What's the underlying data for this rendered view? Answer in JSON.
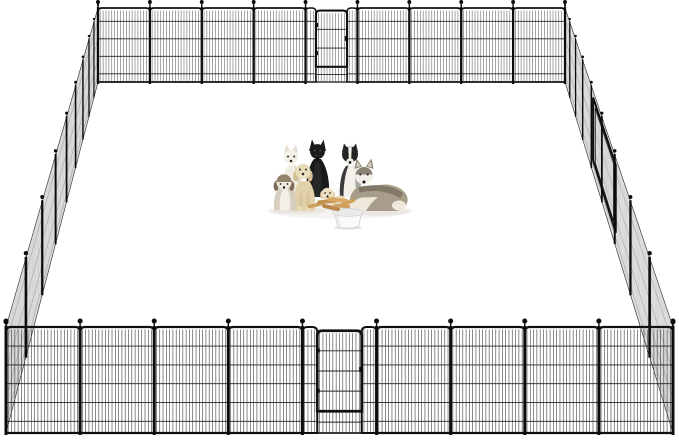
{
  "image": {
    "width": 679,
    "height": 440,
    "background": "#ffffff",
    "scene_description": "Black metal dog playpen fence enclosure, square layout with front and back gate doors, group of dogs with a white food bowl of treat sticks inside"
  },
  "fence": {
    "frame_color": "#101010",
    "wire_color": "#3a3a3a",
    "post_color": "#0c0c0c",
    "side_fill": "#ececec",
    "side_hatch": "#c9c9c9",
    "side_rail": "#9a9a9a",
    "side_outline": "#3c3c3c",
    "back_row": {
      "x1": 98,
      "x2": 565,
      "y_top": 8,
      "y_bottom": 82,
      "panel_count": 9,
      "gate_index": 4,
      "frame_width": 1.7,
      "wire_step": 2.9,
      "h_wires": 4,
      "corner_radius": 4
    },
    "front_row": {
      "x1": 6,
      "x2": 673,
      "y_top": 327,
      "y_bottom": 433,
      "panel_count": 9,
      "gate_index": 4,
      "frame_width": 2.2,
      "wire_step": 3.3,
      "h_wires": 5,
      "corner_radius": 5
    },
    "left_side": {
      "back_top": [
        98,
        8
      ],
      "back_bottom": [
        98,
        82
      ],
      "front_top": [
        6,
        327
      ],
      "front_bottom": [
        6,
        433
      ],
      "panel_count": 9,
      "ratio": 1.22,
      "has_door": false
    },
    "right_side": {
      "back_top": [
        565,
        8
      ],
      "back_bottom": [
        565,
        82
      ],
      "front_top": [
        673,
        327
      ],
      "front_bottom": [
        673,
        433
      ],
      "panel_count": 9,
      "ratio": 1.22,
      "has_door": true,
      "door_t1": 0.26,
      "door_t2": 0.47,
      "door_f1": 0.08,
      "door_f2": 0.84
    }
  },
  "dogs": [
    {
      "id": "black-german-shepherd",
      "pose": "sitting",
      "colors": {
        "body": "#191919",
        "head": "#1b1b1b",
        "chest": "#2e2e2e",
        "muzzle": "#242424",
        "eyes": "#6b5335",
        "nose": "#000000"
      }
    },
    {
      "id": "white-spitz",
      "pose": "sitting",
      "colors": {
        "body": "#f1ede2",
        "shade": "#ddd5c4",
        "head": "#f4f1e9",
        "ears": "#e6dfcf",
        "eyes": "#222222",
        "nose": "#1a1a1a"
      }
    },
    {
      "id": "border-collie",
      "pose": "sitting",
      "colors": {
        "head": "#262626",
        "blaze": "#f4f1ea",
        "chest": "#f4f1ea",
        "shoulder": "#3b3b3b",
        "merle": "#9a9a96",
        "muzzle": "#f2efe7",
        "eyes": "#1b1b1b",
        "nose": "#111111"
      }
    },
    {
      "id": "goldendoodle",
      "pose": "sitting",
      "colors": {
        "body": "#e2d2aa",
        "legs": "#d8c69c",
        "head": "#e8dbb8",
        "ears": "#d2bd92",
        "muzzle": "#f0e6cc",
        "eyes": "#2b2b2b",
        "nose": "#2a2a2a"
      }
    },
    {
      "id": "shih-tzu-puppy",
      "pose": "sitting",
      "colors": {
        "body": "#d7cec0",
        "chest": "#f3efe6",
        "head": "#f0ebdf",
        "cap": "#93826c",
        "ears": "#7c6c58",
        "eyes": "#151515",
        "nose": "#111111"
      }
    },
    {
      "id": "siberian-husky",
      "pose": "lying",
      "colors": {
        "back": "#a79d8a",
        "saddle": "#7b7261",
        "head_cap": "#8b8273",
        "face": "#f2efe8",
        "belly": "#efe9dc",
        "inner_ear": "#d9d2c2",
        "eyes": "#1c1c1c",
        "nose": "#131313"
      }
    },
    {
      "id": "cream-puppy",
      "pose": "lying",
      "colors": {
        "body": "#e7d9b7",
        "head": "#eee0c0",
        "ears": "#d9c79f",
        "eyes": "#222222",
        "nose": "#222222"
      }
    }
  ],
  "bowl": {
    "color": "#fbfbfb",
    "rim": "#f2f2f2",
    "inner": "#e8e8e8",
    "outline": "#cfcfcf",
    "shadow": "#e2e2e2"
  },
  "treats": {
    "colors": [
      "#cf9f62",
      "#c2914f",
      "#daa968",
      "#b9854a",
      "#d3a15e"
    ]
  },
  "shadows": {
    "ground": "#efedeb",
    "dog": "#e6e4e1"
  }
}
